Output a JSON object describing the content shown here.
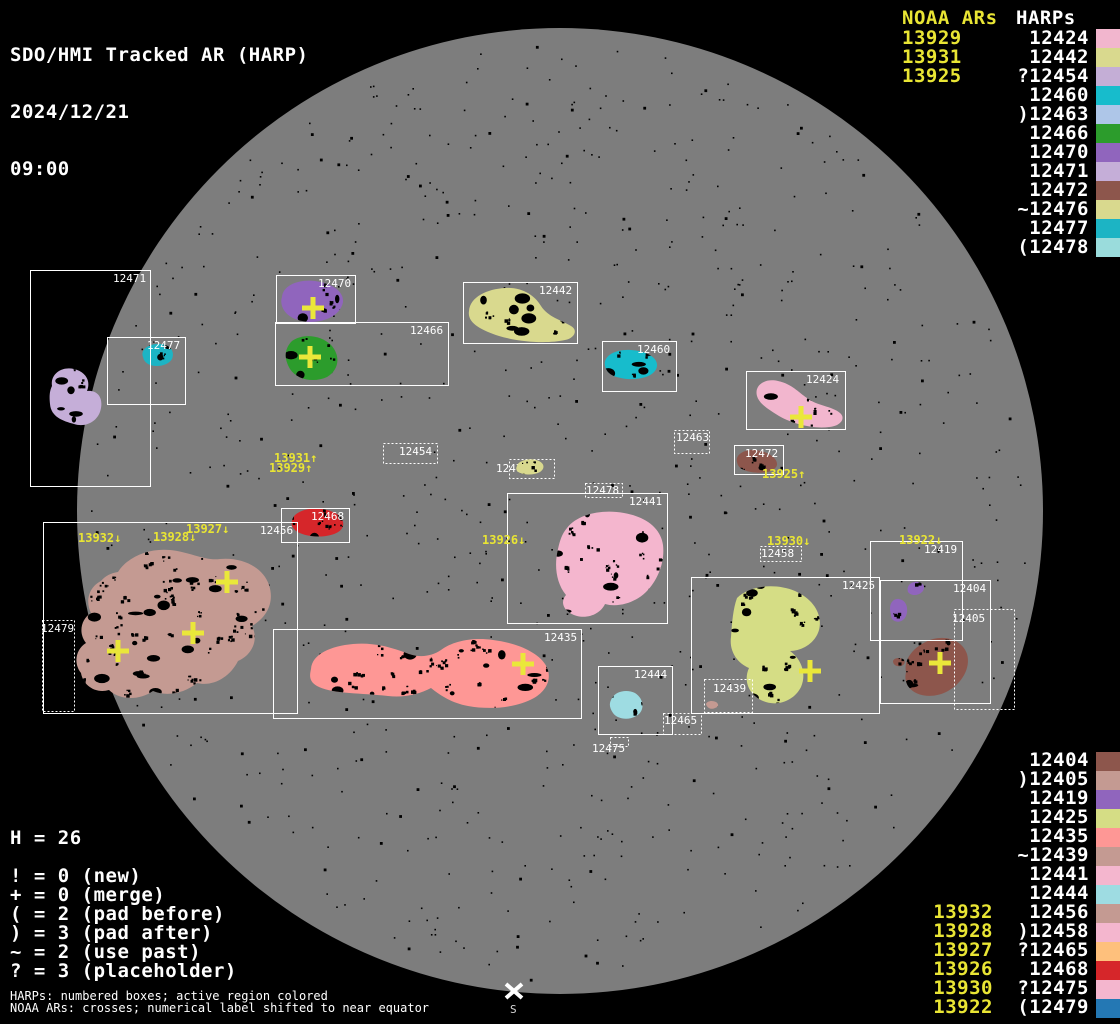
{
  "title": {
    "line1": "SDO/HMI Tracked AR (HARP)",
    "date": "2024/12/21",
    "time": "09:00"
  },
  "colors": {
    "background": "#000000",
    "disk": "#7d7d7d",
    "noaa_text": "#e9e534",
    "harp_text": "#ffffff",
    "box_stroke": "#ffffff",
    "cross": "#eae73a"
  },
  "top_right": {
    "noaa_header": "NOAA ARs",
    "harp_header": "HARPs",
    "noaa_items": [
      "13929",
      "13931",
      "13925"
    ],
    "harp_items": [
      {
        "label": "12424",
        "color": "#f2b6ce"
      },
      {
        "label": "12442",
        "color": "#d9d98e"
      },
      {
        "label": "?12454",
        "color": "#c4aed6"
      },
      {
        "label": "12460",
        "color": "#17bccc"
      },
      {
        "label": ")12463",
        "color": "#aec6e8"
      },
      {
        "label": "12466",
        "color": "#2c9c2c"
      },
      {
        "label": "12470",
        "color": "#9065bd"
      },
      {
        "label": "12471",
        "color": "#c5aed8"
      },
      {
        "label": "12472",
        "color": "#8d564c"
      },
      {
        "label": "~12476",
        "color": "#d9d98e"
      },
      {
        "label": "12477",
        "color": "#1cb4c4"
      },
      {
        "label": "(12478",
        "color": "#9adcdc"
      }
    ]
  },
  "bottom_right": {
    "noaa_items": [
      "13932",
      "13928",
      "13927",
      "13926",
      "13930",
      "13922"
    ],
    "noaa_align_row": 8,
    "harp_items": [
      {
        "label": "12404",
        "color": "#8d564c"
      },
      {
        "label": ")12405",
        "color": "#c49a92"
      },
      {
        "label": "12419",
        "color": "#9065bd"
      },
      {
        "label": "12425",
        "color": "#d5dd85"
      },
      {
        "label": "12435",
        "color": "#fe9795"
      },
      {
        "label": "~12439",
        "color": "#c49a92"
      },
      {
        "label": "12441",
        "color": "#f4b6ce"
      },
      {
        "label": "12444",
        "color": "#9edce2"
      },
      {
        "label": "12456",
        "color": "#c49a92"
      },
      {
        "label": ")12458",
        "color": "#f4b6ce"
      },
      {
        "label": "?12465",
        "color": "#fec07c"
      },
      {
        "label": "12468",
        "color": "#d6262a"
      },
      {
        "label": "?12475",
        "color": "#f4b6ce"
      },
      {
        "label": "(12479",
        "color": "#2478b4"
      }
    ]
  },
  "legend": {
    "h_line": "H = 26",
    "lines": [
      "! = 0 (new)",
      "+ = 0 (merge)",
      "( = 2 (pad before)",
      ") = 3 (pad after)",
      "~ = 2 (use past)",
      "? = 3 (placeholder)"
    ]
  },
  "footer": {
    "line1": "HARPs: numbered boxes; active region colored",
    "line2": "NOAA ARs: crosses; numerical label shifted to near equator"
  },
  "south_marker": {
    "x": 514,
    "y": 991,
    "label": "S"
  },
  "disk": {
    "cx": 560,
    "cy": 511,
    "r": 483
  },
  "harp_boxes": [
    {
      "id": "12471",
      "x": 30,
      "y": 270,
      "w": 120,
      "h": 216,
      "dotted": false,
      "lx": 113,
      "ly": 272
    },
    {
      "id": "12477",
      "x": 107,
      "y": 337,
      "w": 78,
      "h": 67,
      "dotted": false,
      "lx": 147,
      "ly": 339
    },
    {
      "id": "12470",
      "x": 276,
      "y": 275,
      "w": 79,
      "h": 48,
      "dotted": false,
      "lx": 318,
      "ly": 277
    },
    {
      "id": "12466",
      "x": 275,
      "y": 322,
      "w": 173,
      "h": 63,
      "dotted": false,
      "lx": 410,
      "ly": 324
    },
    {
      "id": "12442",
      "x": 463,
      "y": 282,
      "w": 114,
      "h": 61,
      "dotted": false,
      "lx": 539,
      "ly": 284
    },
    {
      "id": "12460",
      "x": 602,
      "y": 341,
      "w": 74,
      "h": 50,
      "dotted": false,
      "lx": 637,
      "ly": 343
    },
    {
      "id": "12424",
      "x": 746,
      "y": 371,
      "w": 99,
      "h": 58,
      "dotted": false,
      "lx": 806,
      "ly": 373
    },
    {
      "id": "12463",
      "x": 674,
      "y": 430,
      "w": 35,
      "h": 23,
      "dotted": true,
      "lx": 676,
      "ly": 431
    },
    {
      "id": "12472",
      "x": 734,
      "y": 445,
      "w": 49,
      "h": 29,
      "dotted": false,
      "lx": 745,
      "ly": 447
    },
    {
      "id": "12454",
      "x": 383,
      "y": 443,
      "w": 54,
      "h": 20,
      "dotted": true,
      "lx": 399,
      "ly": 445
    },
    {
      "id": "12476",
      "x": 509,
      "y": 459,
      "w": 45,
      "h": 19,
      "dotted": true,
      "lx": 496,
      "ly": 462
    },
    {
      "id": "12478",
      "x": 585,
      "y": 483,
      "w": 37,
      "h": 14,
      "dotted": true,
      "lx": 586,
      "ly": 484
    },
    {
      "id": "12441",
      "x": 507,
      "y": 493,
      "w": 160,
      "h": 130,
      "dotted": false,
      "lx": 629,
      "ly": 495
    },
    {
      "id": "12468",
      "x": 281,
      "y": 508,
      "w": 68,
      "h": 34,
      "dotted": false,
      "lx": 311,
      "ly": 510
    },
    {
      "id": "12456",
      "x": 43,
      "y": 522,
      "w": 254,
      "h": 191,
      "dotted": false,
      "lx": 260,
      "ly": 524
    },
    {
      "id": "12479",
      "x": 42,
      "y": 620,
      "w": 32,
      "h": 91,
      "dotted": true,
      "lx": 41,
      "ly": 622
    },
    {
      "id": "12435",
      "x": 273,
      "y": 629,
      "w": 308,
      "h": 89,
      "dotted": false,
      "lx": 544,
      "ly": 631
    },
    {
      "id": "12444",
      "x": 598,
      "y": 666,
      "w": 74,
      "h": 68,
      "dotted": false,
      "lx": 634,
      "ly": 668
    },
    {
      "id": "12465",
      "x": 663,
      "y": 713,
      "w": 38,
      "h": 21,
      "dotted": true,
      "lx": 664,
      "ly": 714
    },
    {
      "id": "12475",
      "x": 610,
      "y": 737,
      "w": 18,
      "h": 9,
      "dotted": true,
      "lx": 592,
      "ly": 742
    },
    {
      "id": "12439",
      "x": 704,
      "y": 679,
      "w": 48,
      "h": 33,
      "dotted": true,
      "lx": 713,
      "ly": 682
    },
    {
      "id": "12425",
      "x": 691,
      "y": 577,
      "w": 188,
      "h": 136,
      "dotted": false,
      "lx": 842,
      "ly": 579
    },
    {
      "id": "12419",
      "x": 870,
      "y": 541,
      "w": 92,
      "h": 99,
      "dotted": false,
      "lx": 924,
      "ly": 543
    },
    {
      "id": "12404",
      "x": 880,
      "y": 580,
      "w": 110,
      "h": 123,
      "dotted": false,
      "lx": 953,
      "ly": 582
    },
    {
      "id": "12405",
      "x": 954,
      "y": 609,
      "w": 60,
      "h": 100,
      "dotted": true,
      "lx": 952,
      "ly": 612
    },
    {
      "id": "12458",
      "x": 760,
      "y": 546,
      "w": 41,
      "h": 15,
      "dotted": true,
      "lx": 761,
      "ly": 547
    }
  ],
  "regions": [
    {
      "id": "12471",
      "color": "#c5aed8",
      "speckles": 10,
      "bbox": [
        46,
        366,
        58,
        62
      ],
      "path": "M52,386 C50,374 62,366 74,369 C86,372 91,381 87,391 C97,390 103,397 101,408 C99,421 86,428 74,424 C63,421 51,417 50,404 C49,395 50,390 52,386 Z"
    },
    {
      "id": "12477",
      "color": "#1cb4c4",
      "speckles": 4,
      "bbox": [
        140,
        342,
        36,
        27
      ],
      "path": "M143,357 C140,349 150,343 161,344 C171,345 175,352 172,359 C168,366 155,368 148,364 C144,361 144,360 143,357 Z"
    },
    {
      "id": "12470",
      "color": "#9065bd",
      "speckles": 10,
      "bbox": [
        280,
        279,
        65,
        44
      ],
      "path": "M282,297 C283,285 299,279 315,281 C331,283 344,291 343,302 C341,314 327,322 310,322 C294,321 285,315 282,306 C281,302 281,300 282,297 Z"
    },
    {
      "id": "12466",
      "color": "#2c9c2c",
      "speckles": 9,
      "bbox": [
        284,
        333,
        56,
        48
      ],
      "path": "M292,341 C303,333 321,335 331,345 C341,356 339,370 327,377 C314,383 297,380 290,369 C284,359 284,349 292,341 Z"
    },
    {
      "id": "12442",
      "color": "#d9d98e",
      "speckles": 14,
      "bbox": [
        466,
        286,
        112,
        57
      ],
      "path": "M469,311 C470,297 487,289 505,288 C523,287 535,296 541,306 C548,317 561,320 571,326 C578,330 575,338 565,340 C547,344 519,342 499,336 C481,330 467,323 469,311 Z"
    },
    {
      "id": "12460",
      "color": "#17bccc",
      "speckles": 8,
      "bbox": [
        603,
        349,
        56,
        31
      ],
      "path": "M605,366 C603,356 615,349 631,350 C647,351 658,358 657,366 C656,375 643,380 627,379 C611,377 607,373 605,366 Z"
    },
    {
      "id": "12424",
      "color": "#f2b6ce",
      "speckles": 10,
      "bbox": [
        754,
        378,
        92,
        51
      ],
      "path": "M757,396 C754,385 765,378 778,381 C792,384 798,392 807,398 C817,406 832,406 840,413 C846,418 841,426 829,427 C813,429 793,424 779,416 C766,408 759,403 757,396 Z"
    },
    {
      "id": "12472",
      "color": "#8d564c",
      "speckles": 6,
      "bbox": [
        735,
        449,
        44,
        25
      ],
      "path": "M737,462 C735,455 744,449 755,450 C767,451 778,458 777,465 C775,472 763,474 751,472 C741,470 738,467 737,462 Z"
    },
    {
      "id": "12476",
      "color": "#d9d98e",
      "speckles": 3,
      "bbox": [
        515,
        458,
        32,
        18
      ],
      "above_label": true,
      "path": "M517,466 C518,461 528,458 536,460 C544,462 546,468 540,472 C533,476 521,475 517,471 C516,469 516,468 517,466 Z"
    },
    {
      "id": "12441",
      "color": "#f4b6ce",
      "speckles": 30,
      "bbox": [
        554,
        509,
        111,
        110
      ],
      "path": "M567,528 C578,514 602,509 624,513 C647,517 661,529 663,545 C665,562 658,580 646,592 C636,602 619,608 605,604 C601,613 589,619 577,616 C565,613 559,603 566,595 C556,583 554,565 558,549 C560,540 562,534 567,528 Z"
    },
    {
      "id": "12468",
      "color": "#d6262a",
      "speckles": 7,
      "bbox": [
        290,
        507,
        55,
        31
      ],
      "path": "M292,521 C293,512 308,507 322,509 C336,511 345,518 343,526 C341,534 326,538 311,536 C297,534 290,528 292,521 Z"
    },
    {
      "id": "12456",
      "color": "#c49a92",
      "speckles": 70,
      "bbox": [
        75,
        548,
        200,
        152
      ],
      "path": "M118,572 C128,556 150,548 170,550 C190,552 205,561 220,559 C242,557 263,567 269,585 C275,603 266,618 252,626 C259,640 252,655 238,661 C230,677 213,687 197,683 C185,693 167,697 153,691 C139,701 119,700 109,690 C95,694 83,685 81,673 C73,663 76,649 86,643 C78,633 81,619 91,613 C85,601 89,587 101,581 C105,576 111,573 118,572 Z"
    },
    {
      "id": "12435",
      "color": "#fe9795",
      "speckles": 55,
      "bbox": [
        305,
        637,
        248,
        74
      ],
      "path": "M311,669 C312,654 331,646 353,644 C375,642 393,648 409,654 C421,658 432,656 441,650 C453,641 473,637 493,640 C517,643 537,652 545,664 C553,676 548,690 534,698 C516,708 490,710 468,706 C452,703 441,696 431,688 C420,694 404,698 388,696 C362,693 331,694 317,686 C308,681 310,674 311,669 Z"
    },
    {
      "id": "12444",
      "color": "#9edce2",
      "speckles": 5,
      "bbox": [
        609,
        689,
        38,
        33
      ],
      "path": "M612,698 C616,691 627,689 635,693 C643,698 645,708 639,714 C631,721 618,720 613,713 C609,707 609,703 612,698 Z"
    },
    {
      "id": "12439",
      "color": "#c49a92",
      "speckles": 1,
      "bbox": [
        705,
        700,
        15,
        10
      ],
      "path": "M706,704 C707,701 712,700 716,702 C719,704 719,707 715,708 C711,710 707,708 706,704 Z"
    },
    {
      "id": "12425",
      "color": "#d5dd85",
      "speckles": 35,
      "bbox": [
        729,
        583,
        94,
        126
      ],
      "path": "M737,598 C750,585 776,583 795,591 C813,599 823,614 819,630 C815,644 801,651 790,651 C801,659 807,673 801,687 C794,701 777,707 763,701 C749,695 743,681 749,668 C737,663 729,651 731,637 C732,623 733,609 737,598 Z"
    },
    {
      "id": "12419",
      "color": "#9065bd",
      "speckles": 2,
      "bbox": [
        906,
        580,
        20,
        17
      ],
      "path": "M908,592 C906,586 911,581 918,582 C924,583 926,588 922,592 C918,596 911,596 908,592 Z"
    },
    {
      "id": "12419",
      "color": "#9065bd",
      "speckles": 2,
      "bbox": [
        888,
        597,
        22,
        27
      ],
      "path": "M891,614 C888,606 892,598 899,599 C906,600 909,608 906,616 C903,623 895,623 892,619 C891,617 891,616 891,614 Z"
    },
    {
      "id": "12404",
      "color": "#8d564c",
      "speckles": 16,
      "bbox": [
        903,
        637,
        68,
        62
      ],
      "path": "M906,672 C903,657 917,644 933,639 C949,635 963,642 967,654 C971,668 962,683 948,691 C934,699 915,697 908,686 C905,681 905,677 906,672 Z"
    },
    {
      "id": "12404",
      "color": "#8d564c",
      "speckles": 1,
      "bbox": [
        892,
        656,
        14,
        11
      ],
      "path": "M893,661 C894,658 899,657 903,659 C906,661 905,665 901,666 C897,667 893,665 893,661 Z"
    }
  ],
  "crosses": [
    [
      313,
      308
    ],
    [
      310,
      357
    ],
    [
      801,
      417
    ],
    [
      227,
      582
    ],
    [
      193,
      633
    ],
    [
      118,
      651
    ],
    [
      523,
      664
    ],
    [
      810,
      671
    ],
    [
      940,
      663
    ]
  ],
  "noaa_disk_labels": [
    {
      "text": "13931↑",
      "x": 274,
      "y": 452
    },
    {
      "text": "13929↑",
      "x": 269,
      "y": 462
    },
    {
      "text": "13925↑",
      "x": 762,
      "y": 468
    },
    {
      "text": "13932↓",
      "x": 78,
      "y": 532
    },
    {
      "text": "13928↓",
      "x": 153,
      "y": 531
    },
    {
      "text": "13927↓",
      "x": 186,
      "y": 523
    },
    {
      "text": "13926↓",
      "x": 482,
      "y": 534
    },
    {
      "text": "13930↓",
      "x": 767,
      "y": 535
    },
    {
      "text": "13922↓",
      "x": 899,
      "y": 534
    }
  ],
  "chart_data": {
    "type": "table",
    "title": "SDO/HMI Tracked AR (HARP) 2024/12/21 09:00",
    "harp_total": 26,
    "flag_counts": {
      "new": 0,
      "merge": 0,
      "pad_before": 2,
      "pad_after": 3,
      "use_past": 2,
      "placeholder": 3
    },
    "noaa_ars": [
      "13929",
      "13931",
      "13925",
      "13932",
      "13928",
      "13927",
      "13926",
      "13930",
      "13922"
    ],
    "harps": [
      "12424",
      "12442",
      "?12454",
      "12460",
      ")12463",
      "12466",
      "12470",
      "12471",
      "12472",
      "~12476",
      "12477",
      "(12478",
      "12404",
      ")12405",
      "12419",
      "12425",
      "12435",
      "~12439",
      "12441",
      "12444",
      "12456",
      ")12458",
      "?12465",
      "12468",
      "?12475",
      "(12479"
    ]
  }
}
